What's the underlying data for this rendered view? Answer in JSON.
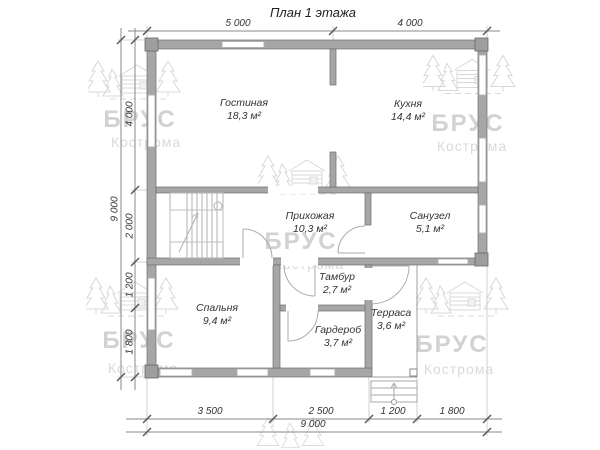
{
  "title": "План 1 этажа",
  "watermark": {
    "brand": "БРУС",
    "city": "Кострома"
  },
  "rooms": [
    {
      "name": "Гостиная",
      "area": "18,3 м²"
    },
    {
      "name": "Кухня",
      "area": "14,4 м²"
    },
    {
      "name": "Прихожая",
      "area": "10,3 м²"
    },
    {
      "name": "Санузел",
      "area": "5,1 м²"
    },
    {
      "name": "Спальня",
      "area": "9,4 м²"
    },
    {
      "name": "Тамбур",
      "area": "2,7 м²"
    },
    {
      "name": "Гардероб",
      "area": "3,7 м²"
    },
    {
      "name": "Терраса",
      "area": "3,6 м²"
    }
  ],
  "dimensions": {
    "top": [
      "5 000",
      "4 000"
    ],
    "left": [
      "4 000",
      "2 000",
      "1 200",
      "1 800"
    ],
    "left_total": "9 000",
    "bottom": [
      "3 500",
      "2 500",
      "1 200",
      "1 800"
    ],
    "bottom_total": "9 000"
  }
}
